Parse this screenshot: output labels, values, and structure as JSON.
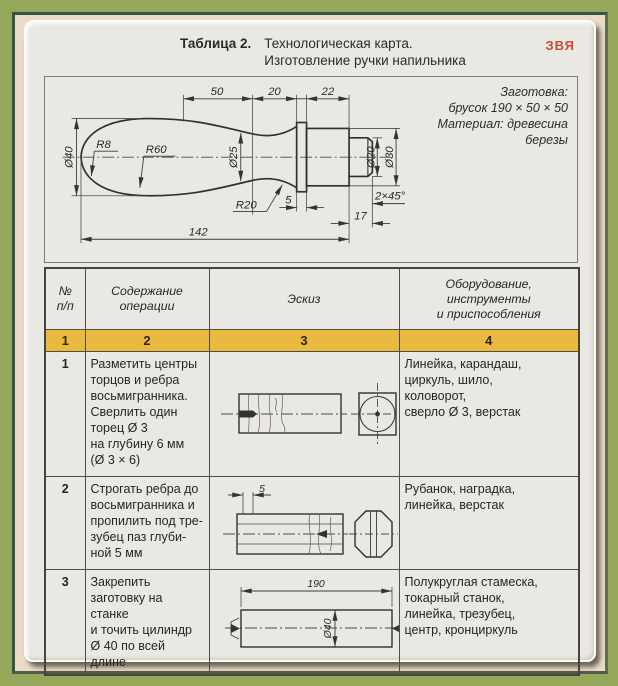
{
  "palette": {
    "frame_green": "#95a85a",
    "mat_beige": "#ebdac5",
    "accent_dark_teal": "#35524b",
    "card_bg": "#eae8e2",
    "row_yellow": "#e9ba3f",
    "watermark_red": "#cb4a37"
  },
  "title": {
    "prefix": "Таблица 2.",
    "line1": "Технологическая карта.",
    "line2": "Изготовление ручки напильника"
  },
  "watermark": {
    "text": "ЗВЯ"
  },
  "drawing": {
    "note_text": "Заготовка:\nбрусок 190 × 50 × 50\nМатериал: древесина\nберезы",
    "dims": {
      "top50": "50",
      "top20": "20",
      "top22": "22",
      "dia40": "Ø40",
      "r8": "R8",
      "r60": "R60",
      "dia25": "Ø25",
      "dia20": "Ø20",
      "dia30": "Ø30",
      "r20": "R20",
      "disc5": "5",
      "chamfer": "2×45°",
      "shank17": "17",
      "total142": "142"
    }
  },
  "table": {
    "headers": {
      "col1": "№\nп/п",
      "col2": "Содержание\nоперации",
      "col3": "Эскиз",
      "col4": "Оборудование,\nинструменты\nи приспособления"
    },
    "number_row": {
      "c1": "1",
      "c2": "2",
      "c3": "3",
      "c4": "4"
    },
    "rows": [
      {
        "num": "1",
        "operation": "Разметить центры\nторцов и ребра\nвосьмигранника.\nСверлить один\nторец Ø 3\nна глубину 6 мм\n(Ø 3 × 6)",
        "equipment": "Линейка, карандаш,\nциркуль, шило,\nколоворот,\nсверло Ø 3, верстак"
      },
      {
        "num": "2",
        "operation": "Строгать ребра до\nвосьмигранника и\nпропилить под тре-\nзубец паз глуби-\nной 5 мм",
        "equipment": "Рубанок, наградка,\nлинейка, верстак",
        "sketch_dim": "5"
      },
      {
        "num": "3",
        "operation": "Закрепить\nзаготовку на станке\nи точить цилиндр\nØ 40 по всей длине",
        "equipment": "Полукруглая стамеска,\nтокарный станок,\nлинейка, трезубец,\nцентр, кронциркуль",
        "sketch_dims": {
          "length": "190",
          "dia": "Ø40"
        }
      }
    ]
  }
}
